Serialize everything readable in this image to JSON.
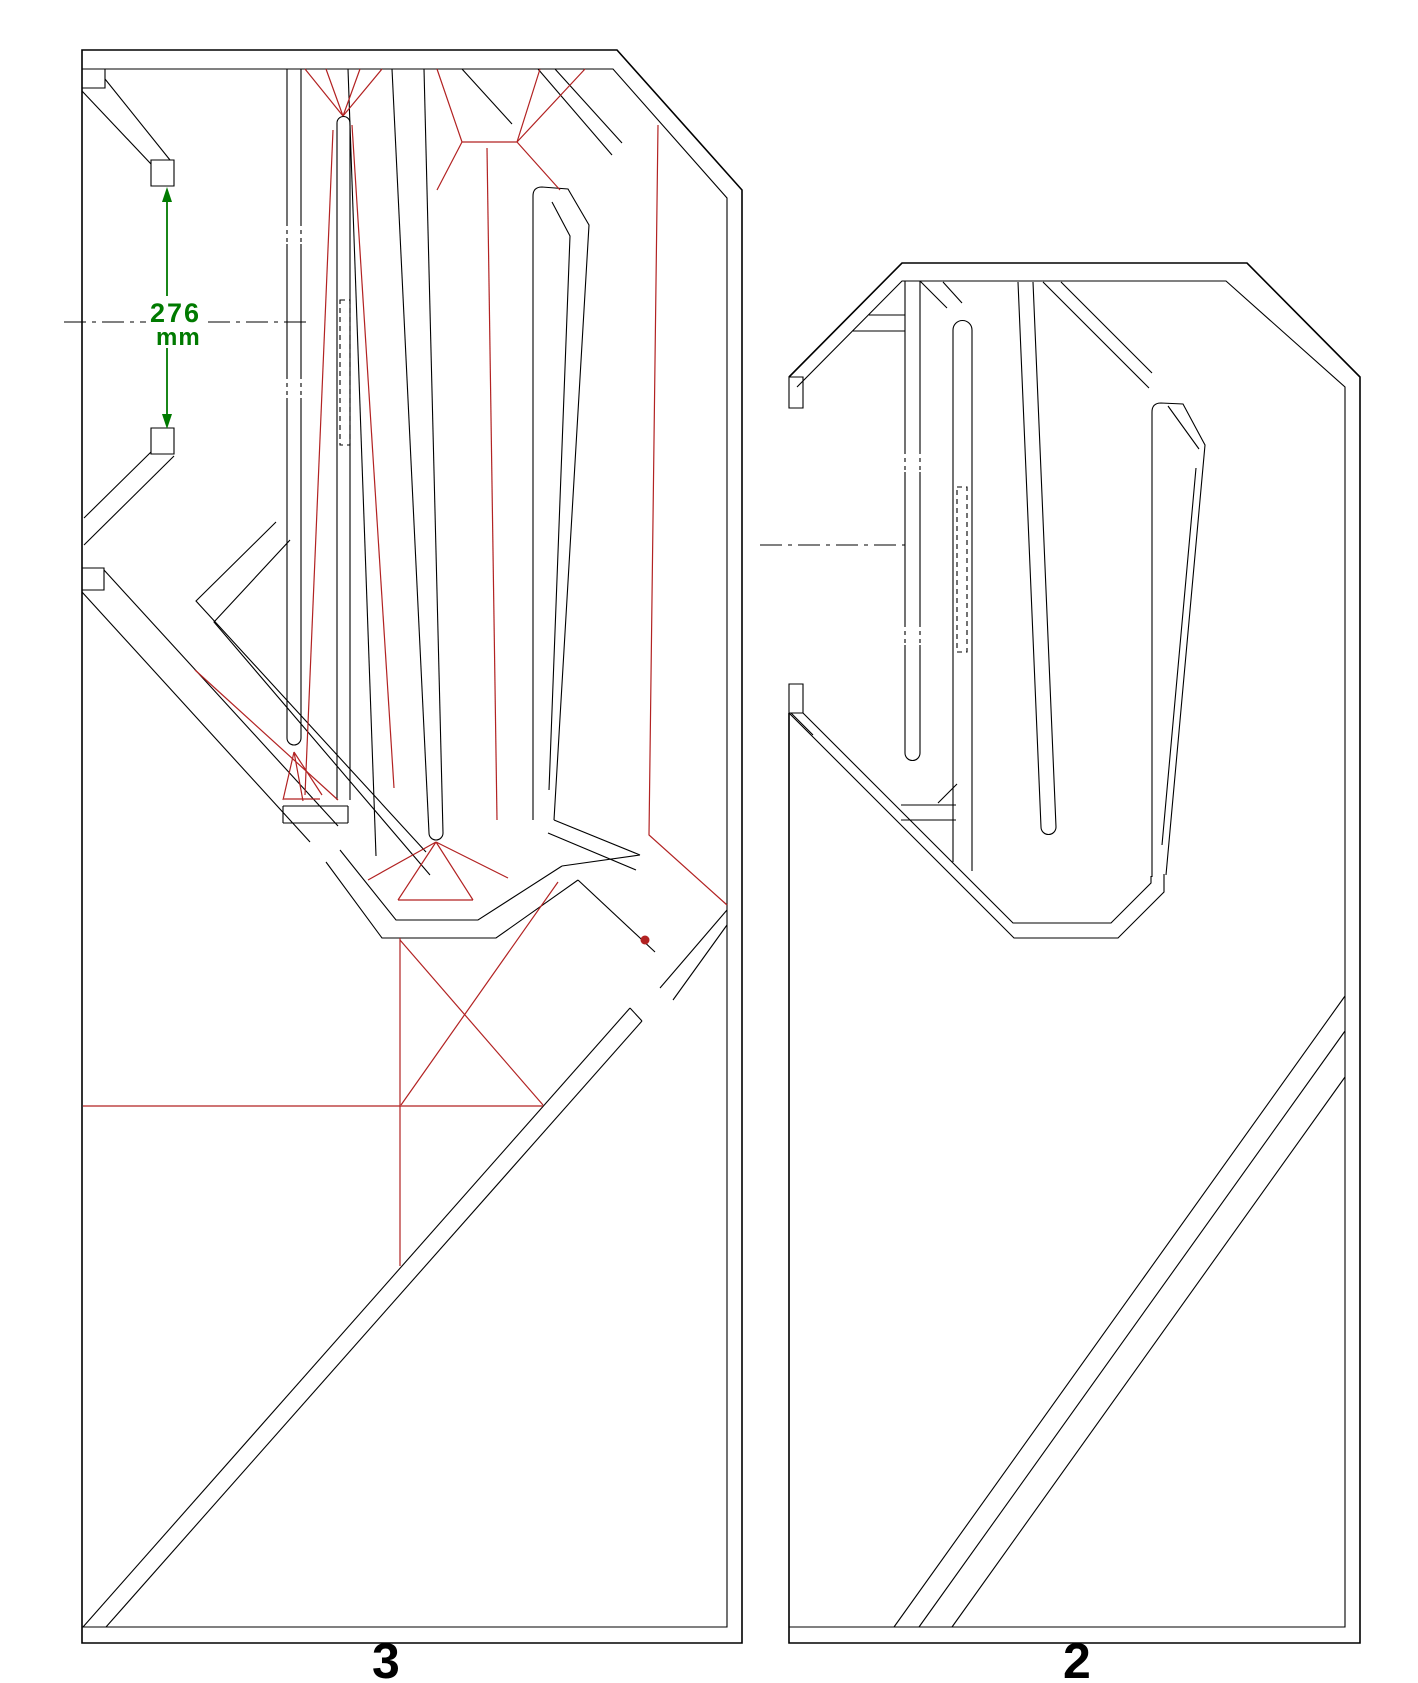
{
  "diagram": {
    "type": "cad-technical-drawing",
    "description": "Construction plan of two cabinet side panels shown in section with fold/cut lines",
    "panels": [
      {
        "label": "3",
        "dimension": {
          "value": "276",
          "unit": "mm"
        }
      },
      {
        "label": "2"
      }
    ],
    "colors": {
      "outline": "#000000",
      "fold_lines": "#B22222",
      "dimension": "#007A00",
      "background": "#FFFFFF"
    }
  }
}
